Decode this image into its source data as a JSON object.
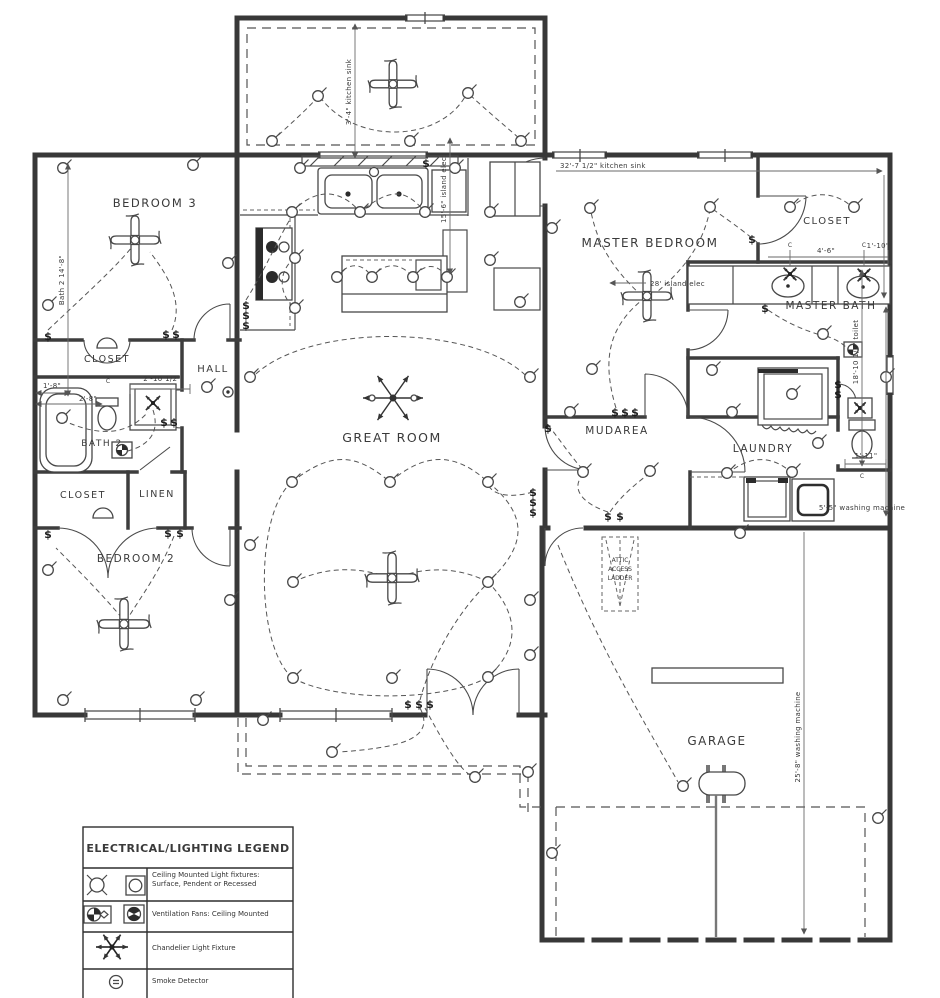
{
  "drawing": {
    "rooms": {
      "bedroom3": "BEDROOM 3",
      "closet_bath": "CLOSET",
      "hall": "HALL",
      "bath2": "BATH 2",
      "closet_bed2": "CLOSET",
      "linen": "LINEN",
      "bedroom2": "BEDROOM 2",
      "great_room": "GREAT ROOM",
      "master_bedroom": "MASTER BEDROOM",
      "master_closet": "CLOSET",
      "master_bath": "MASTER BATH",
      "mudarea": "MUDAREA",
      "laundry": "LAUNDRY",
      "garage": "GARAGE",
      "attic_line1": "ATTIC",
      "attic_line2": "ACCESS",
      "attic_line3": "LADDER"
    },
    "dimensions": {
      "bath2_run": "Bath 2 14'-8\"",
      "kitchen_sink_v": "3'-4\" kitchen sink",
      "island_elec_v": "15'-6\" island elec",
      "kitchen_sink_h": "32'-7 1/2\" kitchen sink",
      "island_elec_h": "28' island elec",
      "vanity_span": "4'-6\"",
      "vanity_edge": "1'-10\"",
      "hall_door": "2'-10 1/2\"",
      "tub_a": "1'-8\"",
      "tub_b": "2'-8\"",
      "toilet_run": "18'-10 1/2\" toilet",
      "toilet_edge": "1'-11\"",
      "washer_span": "5'-5\" washing machine",
      "washer_run": "25'-8\" washing machine"
    },
    "glyphs": {
      "switch": "$",
      "centerline": "C"
    }
  },
  "legend": {
    "title": "ELECTRICAL/LIGHTING LEGEND",
    "rows": [
      {
        "label": "Ceiling Mounted Light fixtures: Surface, Pendent or Recessed"
      },
      {
        "label": "Ventilation Fans: Ceiling Mounted"
      },
      {
        "label": "Chandelier Light Fixture"
      },
      {
        "label": "Smoke Detector"
      }
    ]
  }
}
